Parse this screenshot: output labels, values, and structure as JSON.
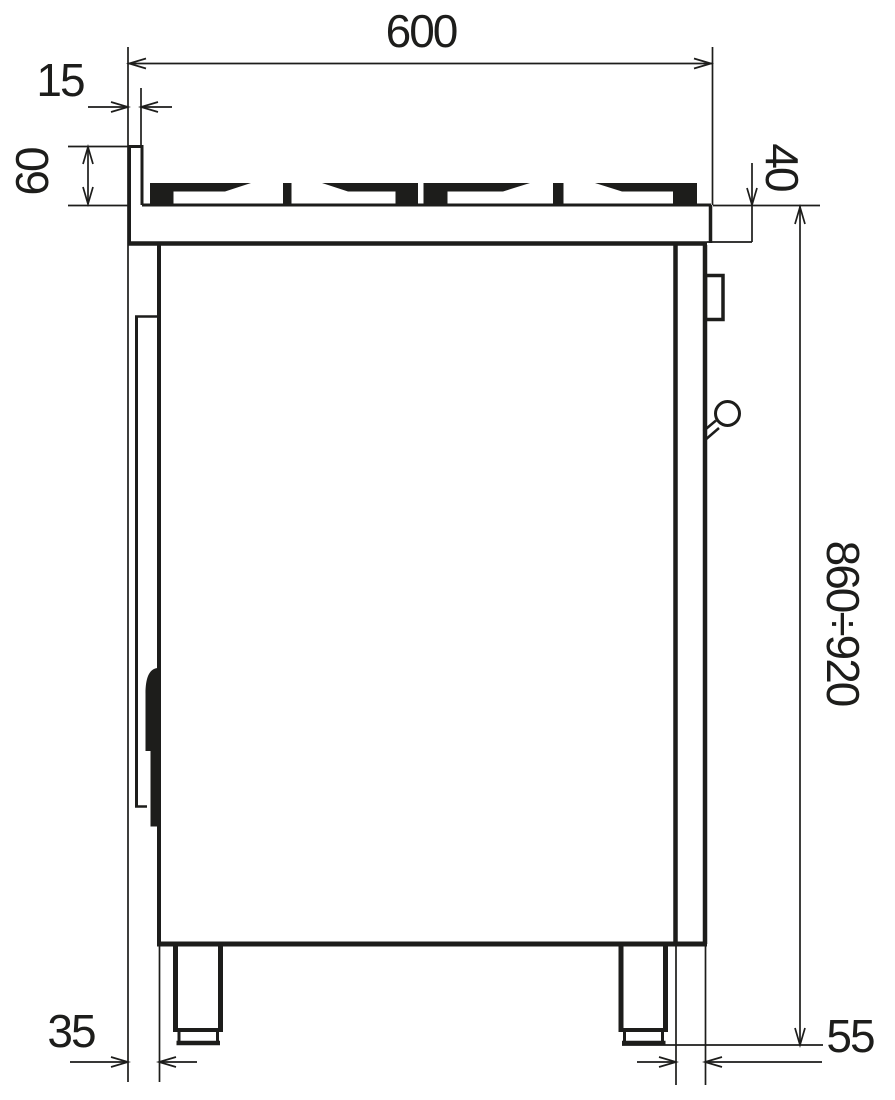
{
  "drawing": {
    "dim_labels": {
      "width": "600",
      "back_offset": "15",
      "back_lip_height": "60",
      "top_thickness": "40",
      "height_range": "860÷920",
      "back_foot_inset": "35",
      "front_foot_inset": "55"
    }
  }
}
